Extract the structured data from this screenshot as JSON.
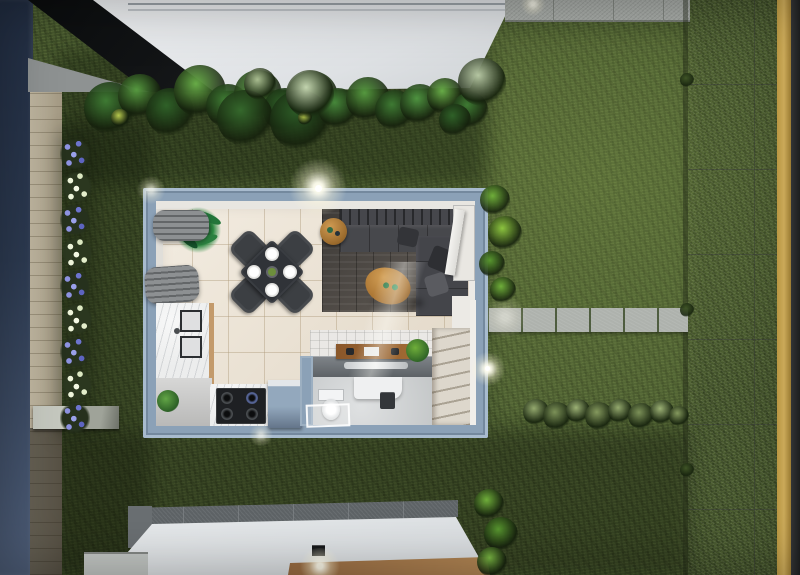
{
  "scene": {
    "type": "3d-architectural-render",
    "view": "top-down dollhouse cutaway at dusk",
    "lighting": "exterior wall lights switched on, soft light pools on lawn and floors",
    "rooms": [
      "dining area",
      "living room",
      "kitchen",
      "bathroom",
      "stair hall"
    ],
    "furniture": [
      "square dining table rotated 45 degrees with four charcoal chairs and four white place settings",
      "charcoal L-shaped sectional sofa with scatter cushions",
      "oval wooden coffee table with two green cups",
      "round wooden side table",
      "dark potted palm in dining corner",
      "grey pleated window curtains along left wall",
      "white marble L-shaped kitchen counter with double sink",
      "black four-burner gas cooktop",
      "blue-grey kitchen island unit",
      "grey vanity counter with wooden desk organizer, metal tray and small plant",
      "white toilet with cistern",
      "white bath mat",
      "dark waste bin",
      "white staircase rising along the right wall",
      "white entry door standing open at the top right corner"
    ],
    "exterior": [
      "lawn surrounding the house",
      "tropical shrub bed along the upper neighbouring building",
      "flower bed with alternating purple and white clusters on the left",
      "navy blue boundary wall on far left",
      "beige brick side path",
      "concrete ledge on the left path",
      "stepping-stone path from house to street",
      "row of pale green hedge shrubs",
      "grey paver street with yellow edge line and dark asphalt strip on the right",
      "paver sidewalk along the top",
      "white flat roof of upper neighbouring building",
      "white flat roof of lower neighbouring building with brown deck edge and lit wall lamp"
    ]
  },
  "palette": {
    "grass": "#47582e",
    "house_wall": "#8ba1b7",
    "interior_tile": "#efe6d7",
    "living_floor": "#534e49",
    "marble": "#eceded",
    "street": "#a3a7a2",
    "street_yellow_line": "#d9b355",
    "asphalt": "#2a2c2d",
    "navy_wall": "#2d3b52",
    "brick_path": "#b9ae95",
    "roof_white": "#e3e6e8",
    "deck_brown": "#a87a4e",
    "sofa": "#46474a",
    "wood_table": "#b5813f",
    "shrub_green": "#55983f",
    "flower_purple": "#8d92e0",
    "flower_white": "#eef4da"
  }
}
